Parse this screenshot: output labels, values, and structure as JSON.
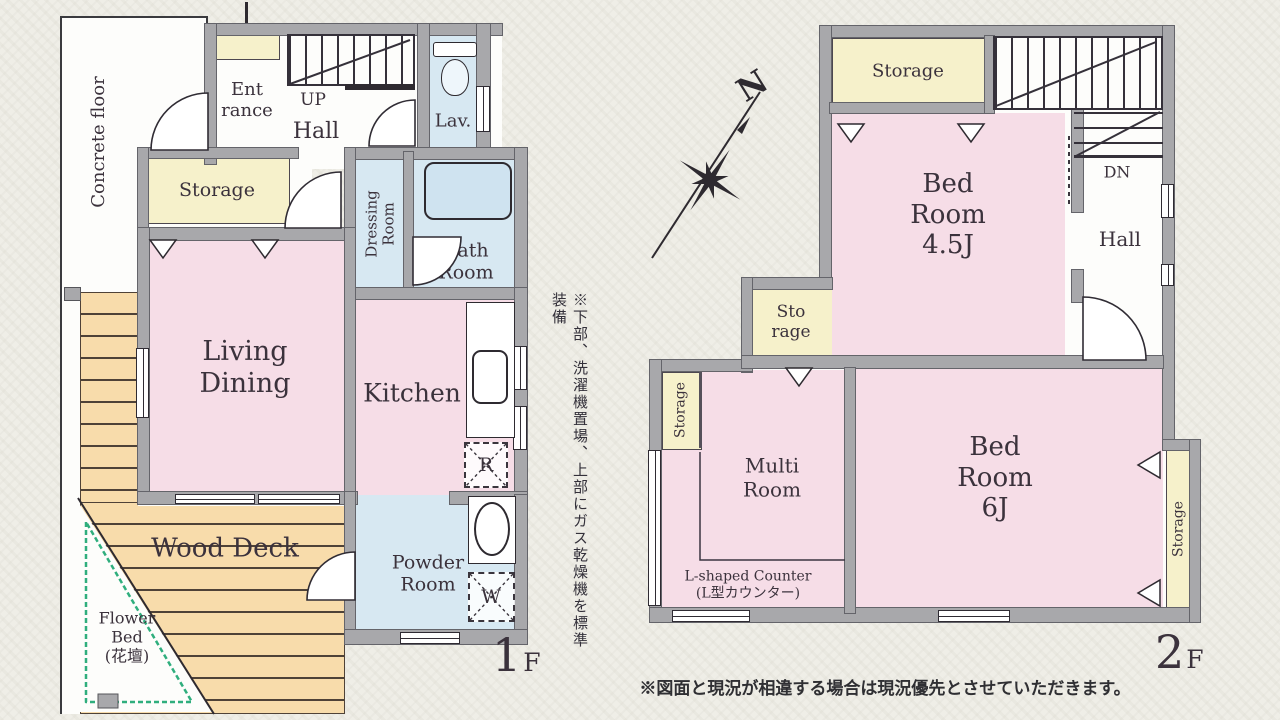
{
  "colors": {
    "background": "#efeee7",
    "wall_gray": "#a8a8ab",
    "room_pink": "#f6dde7",
    "room_blue": "#d7e8f2",
    "room_yellow": "#f6f1cb",
    "deck_tan": "#f8dcab",
    "flower_green": "#2fae7d",
    "text_dark": "#3b323c"
  },
  "floor1": {
    "floor_num": "1",
    "floor_suffix": "F",
    "concrete_floor": "Concrete floor",
    "entrance": "Ent\nrance",
    "up": "UP",
    "hall": "Hall",
    "lav": "Lav.",
    "storage": "Storage",
    "dressing": "Dressing\nRoom",
    "bath": "Bath\nRoom",
    "living": "Living\nDining",
    "kitchen": "Kitchen",
    "fridge": "R",
    "washer": "W",
    "powder": "Powder\nRoom",
    "wood_deck": "Wood Deck",
    "flower_bed": "Flower\nBed\n(花壇)",
    "side_note": "※下部、洗濯機置場、上部にガス乾燥機を標準装備"
  },
  "floor2": {
    "floor_num": "2",
    "floor_suffix": "F",
    "north": "N",
    "storage_top": "Storage",
    "dn": "DN",
    "hall": "Hall",
    "bedroom45": "Bed\nRoom\n4.5J",
    "storage_small": "Sto\nrage",
    "storage_left": "Storage",
    "multi": "Multi\nRoom",
    "bedroom6": "Bed\nRoom\n6J",
    "storage_right": "Storage",
    "counter": "L-shaped Counter\n(L型カウンター)",
    "bottom_note": "※図面と現況が相違する場合は現況優先とさせていただきます。"
  }
}
